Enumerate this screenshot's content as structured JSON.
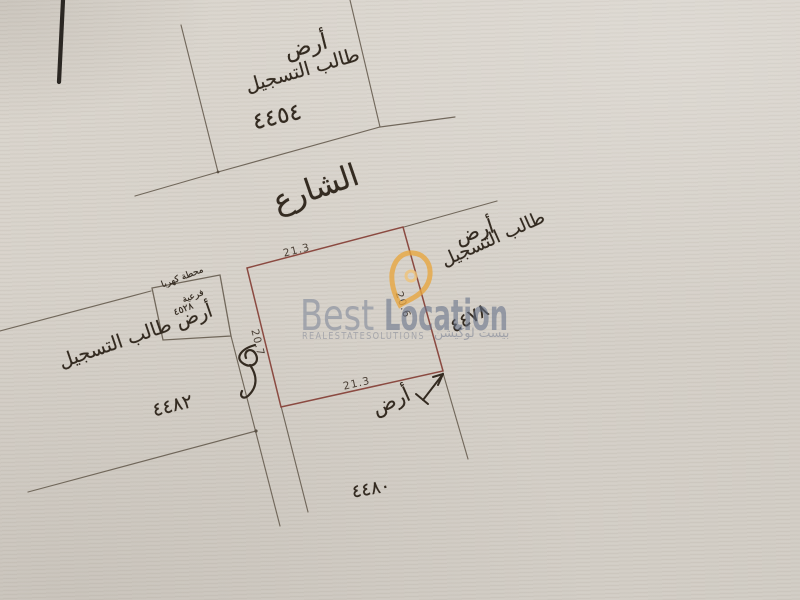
{
  "sheet": {
    "street_label": "الشارع",
    "parcels": {
      "north": {
        "line1": "أرض",
        "line2": "طالب التسجيل",
        "number": "٤٤٥٤"
      },
      "east": {
        "line1": "أرض",
        "line2": "طالب التسجيل",
        "number": "٤٤٧٨"
      },
      "west": {
        "line1": "أرض طالب التسجيل",
        "number": "٤٤٨٢"
      },
      "south": {
        "line1": "أرض",
        "number": "٤٤٨٠"
      },
      "substation": {
        "line1": "محطة كهربا",
        "line2": "فرعية",
        "line3": "٤٥٢٨"
      }
    },
    "central_parcel_dimensions": {
      "top": "21.3",
      "right": "20.6",
      "bottom": "21.3",
      "left": "20.7"
    }
  },
  "watermark": {
    "brand_word1": "Best",
    "brand_word2": "Location",
    "tagline": "REALESTATESOLUTIONS",
    "arabic": "بيست لوكيشن"
  },
  "colors": {
    "paper": "#d6d1c9",
    "survey_line": "#675d50",
    "parcel_outline_red": "#8b4a41",
    "ink": "#342b21",
    "watermark_gray": "#8a93a5",
    "logo_orange": "#e8a63e"
  }
}
